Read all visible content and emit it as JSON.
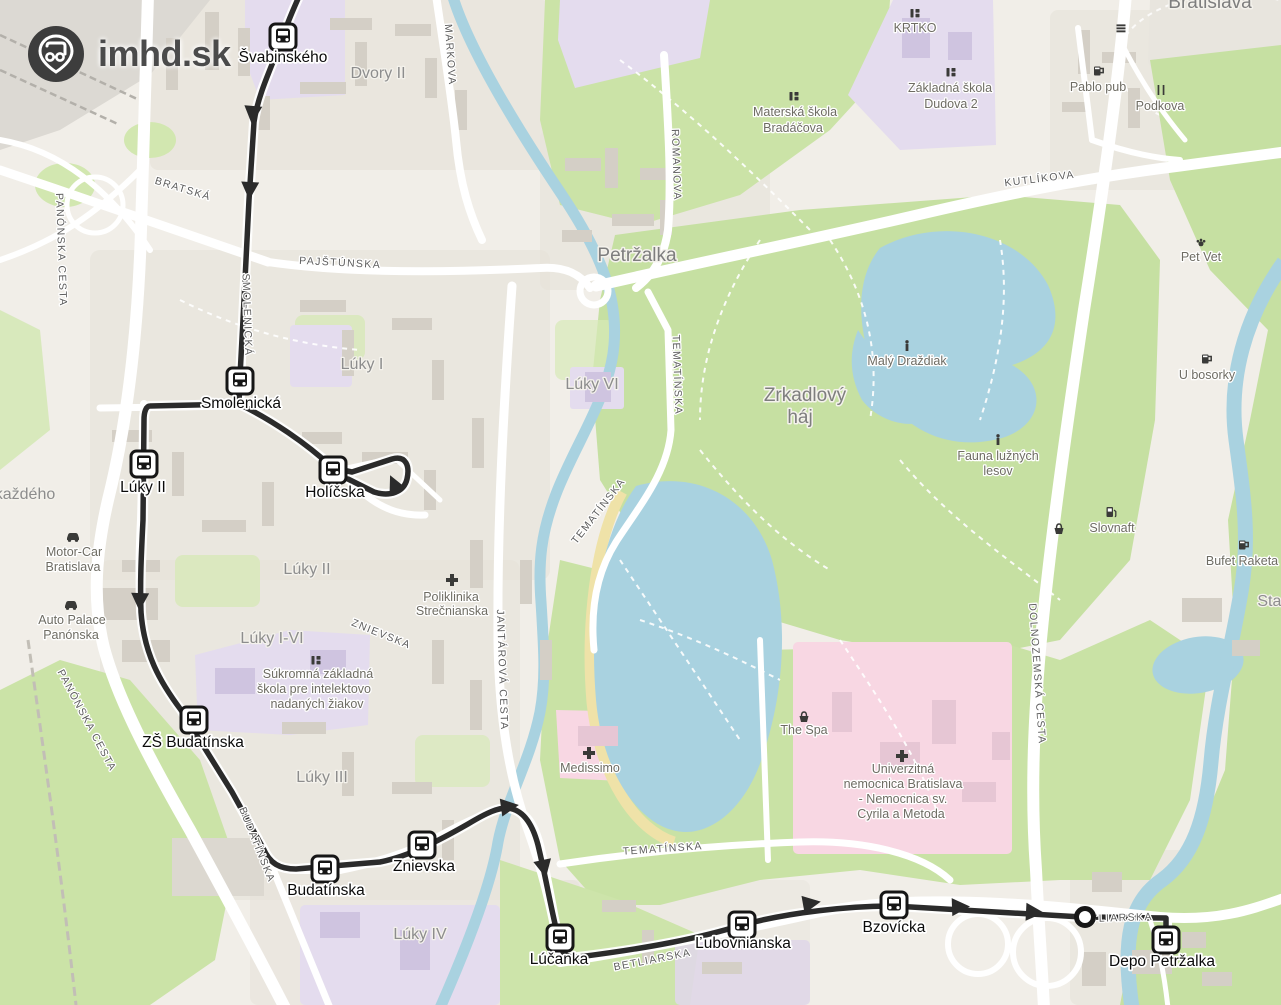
{
  "brand": {
    "site": "imhd.sk"
  },
  "map": {
    "route_color": "#2b2b2b",
    "water_color": "#a9d2e0",
    "park_color": "#cbe3a7",
    "hospital_area_color": "#f8d7e3",
    "school_area_color": "#e4dcee",
    "stops": [
      {
        "name": "Švabinského",
        "x": 283,
        "y": 37,
        "lx": 283,
        "ly": 62
      },
      {
        "name": "Smolenická",
        "x": 240,
        "y": 381,
        "lx": 241,
        "ly": 408
      },
      {
        "name": "Lúky II",
        "x": 144,
        "y": 464,
        "lx": 143,
        "ly": 492
      },
      {
        "name": "Holíčska",
        "x": 333,
        "y": 470,
        "lx": 335,
        "ly": 497
      },
      {
        "name": "ZŠ Budatínska",
        "x": 194,
        "y": 720,
        "lx": 193,
        "ly": 747
      },
      {
        "name": "Budatínska",
        "x": 325,
        "y": 869,
        "lx": 326,
        "ly": 895
      },
      {
        "name": "Znievska",
        "x": 422,
        "y": 845,
        "lx": 424,
        "ly": 871
      },
      {
        "name": "Lúčanka",
        "x": 560,
        "y": 938,
        "lx": 559,
        "ly": 964
      },
      {
        "name": "Ľubovnianska",
        "x": 742,
        "y": 925,
        "lx": 743,
        "ly": 948
      },
      {
        "name": "Bzovícka",
        "x": 894,
        "y": 905,
        "lx": 894,
        "ly": 932
      },
      {
        "name": "Depo Petržalka",
        "x": 1166,
        "y": 940,
        "lx": 1162,
        "ly": 966
      }
    ],
    "terminus": {
      "x": 1085,
      "y": 917
    },
    "street_labels": [
      {
        "text": "MARKOVA",
        "x": 447,
        "y": 55,
        "rot": 86
      },
      {
        "text": "BRATSKÁ",
        "x": 182,
        "y": 192,
        "rot": 17
      },
      {
        "text": "PAJŠTÚNSKA",
        "x": 340,
        "y": 266,
        "rot": 3
      },
      {
        "text": "ROMANOVA",
        "x": 673,
        "y": 165,
        "rot": 88
      },
      {
        "text": "KUTLÍKOVA",
        "x": 1040,
        "y": 182,
        "rot": -7
      },
      {
        "text": "PANÓNSKA CESTA",
        "x": 58,
        "y": 250,
        "rot": 88
      },
      {
        "text": "SMOLENICKÁ",
        "x": 244,
        "y": 315,
        "rot": 88
      },
      {
        "text": "TEMATÍNSKA",
        "x": 674,
        "y": 375,
        "rot": 88
      },
      {
        "text": "TEMATÍNSKA",
        "x": 601,
        "y": 513,
        "rot": -52
      },
      {
        "text": "JANTÁROVÁ CESTA",
        "x": 499,
        "y": 670,
        "rot": 88
      },
      {
        "text": "ZNIEVSKA",
        "x": 380,
        "y": 637,
        "rot": 22
      },
      {
        "text": "PANÓNSKA CESTA",
        "x": 84,
        "y": 722,
        "rot": 62
      },
      {
        "text": "BUDATÍNSKA",
        "x": 254,
        "y": 846,
        "rot": 68
      },
      {
        "text": "TEMATÍNSKA",
        "x": 663,
        "y": 852,
        "rot": -4
      },
      {
        "text": "BETLIARSKA",
        "x": 653,
        "y": 963,
        "rot": -11
      },
      {
        "text": "DOLNOZEMSKÁ CESTA",
        "x": 1034,
        "y": 674,
        "rot": 86
      },
      {
        "text": "TLIARSKA",
        "x": 1122,
        "y": 921,
        "rot": -2
      }
    ],
    "area_labels": [
      {
        "text": "Dvory II",
        "x": 378,
        "y": 78,
        "big": false
      },
      {
        "text": "Petržalka",
        "x": 637,
        "y": 261,
        "big": true
      },
      {
        "text": "Lúky I",
        "x": 362,
        "y": 369,
        "big": false
      },
      {
        "text": "Lúky VI",
        "x": 592,
        "y": 389,
        "big": false
      },
      {
        "text": "Zrkadlový",
        "x": 805,
        "y": 401,
        "big": true
      },
      {
        "text": "háj",
        "x": 800,
        "y": 423,
        "big": true
      },
      {
        "text": "Lúky II",
        "x": 307,
        "y": 574,
        "big": false
      },
      {
        "text": "Lúky I-VI",
        "x": 272,
        "y": 643,
        "big": false
      },
      {
        "text": "Lúky III",
        "x": 322,
        "y": 782,
        "big": false
      },
      {
        "text": "Lúky IV",
        "x": 420,
        "y": 939,
        "big": false
      },
      {
        "text": "Bratislava",
        "x": 1210,
        "y": 8,
        "big": true
      },
      {
        "text": "každého",
        "x": 25,
        "y": 499,
        "big": false,
        "small": true
      },
      {
        "text": "Star",
        "x": 1272,
        "y": 606,
        "big": false,
        "small": true
      }
    ],
    "pois": [
      {
        "icon": "school",
        "ix": 915,
        "iy": 13,
        "lines": [
          {
            "t": "KRTKO",
            "x": 915,
            "y": 32
          }
        ]
      },
      {
        "icon": "school",
        "ix": 951,
        "iy": 72,
        "lines": [
          {
            "t": "Základná škola",
            "x": 950,
            "y": 92
          },
          {
            "t": "Dudova 2",
            "x": 951,
            "y": 108
          }
        ]
      },
      {
        "icon": "school",
        "ix": 794,
        "iy": 96,
        "lines": [
          {
            "t": "Materská škola",
            "x": 795,
            "y": 116
          },
          {
            "t": "Bradáčova",
            "x": 793,
            "y": 132
          }
        ]
      },
      {
        "icon": "pub",
        "ix": 1098,
        "iy": 71,
        "lines": [
          {
            "t": "Pablo pub",
            "x": 1098,
            "y": 91
          }
        ]
      },
      {
        "icon": "restaurant",
        "ix": 1161,
        "iy": 90,
        "lines": [
          {
            "t": "Podkova",
            "x": 1160,
            "y": 110
          }
        ]
      },
      {
        "icon": "bench",
        "ix": 1121,
        "iy": 28,
        "lines": []
      },
      {
        "icon": "paw",
        "ix": 1201,
        "iy": 242,
        "lines": [
          {
            "t": "Pet Vet",
            "x": 1201,
            "y": 261
          }
        ]
      },
      {
        "icon": "pub",
        "ix": 1206,
        "iy": 359,
        "lines": [
          {
            "t": "U bosorky",
            "x": 1207,
            "y": 379
          }
        ]
      },
      {
        "icon": "info",
        "ix": 907,
        "iy": 346,
        "lines": [
          {
            "t": "Malý Draždiak",
            "x": 907,
            "y": 365
          }
        ]
      },
      {
        "icon": "info",
        "ix": 998,
        "iy": 440,
        "lines": [
          {
            "t": "Fauna lužných",
            "x": 998,
            "y": 460
          },
          {
            "t": "lesov",
            "x": 998,
            "y": 475
          }
        ]
      },
      {
        "icon": "fuel",
        "ix": 1111,
        "iy": 512,
        "lines": [
          {
            "t": "Slovnaft",
            "x": 1112,
            "y": 532
          }
        ]
      },
      {
        "icon": "basket",
        "ix": 1059,
        "iy": 529,
        "lines": []
      },
      {
        "icon": "pub",
        "ix": 1243,
        "iy": 545,
        "lines": [
          {
            "t": "Bufet Raketa",
            "x": 1242,
            "y": 565
          }
        ]
      },
      {
        "icon": "car",
        "ix": 73,
        "iy": 536,
        "lines": [
          {
            "t": "Motor-Car",
            "x": 74,
            "y": 556
          },
          {
            "t": "Bratislava",
            "x": 73,
            "y": 571
          }
        ]
      },
      {
        "icon": "car",
        "ix": 71,
        "iy": 604,
        "lines": [
          {
            "t": "Auto Palace",
            "x": 72,
            "y": 624
          },
          {
            "t": "Panónska",
            "x": 71,
            "y": 639
          }
        ]
      },
      {
        "icon": "cross",
        "ix": 452,
        "iy": 580,
        "lines": [
          {
            "t": "Poliklinika",
            "x": 451,
            "y": 601
          },
          {
            "t": "Strečnianska",
            "x": 452,
            "y": 615
          }
        ]
      },
      {
        "icon": "school",
        "ix": 316,
        "iy": 660,
        "lines": [
          {
            "t": "Súkromná základná",
            "x": 318,
            "y": 678
          },
          {
            "t": "škola pre intelektovo",
            "x": 314,
            "y": 693
          },
          {
            "t": "nadaných žiakov",
            "x": 317,
            "y": 708
          }
        ]
      },
      {
        "icon": "cross",
        "ix": 589,
        "iy": 753,
        "lines": [
          {
            "t": "Medissimo",
            "x": 590,
            "y": 772
          }
        ]
      },
      {
        "icon": "basket",
        "ix": 804,
        "iy": 717,
        "lines": [
          {
            "t": "The Spa",
            "x": 804,
            "y": 734
          }
        ]
      },
      {
        "icon": "cross",
        "ix": 902,
        "iy": 756,
        "lines": [
          {
            "t": "Univerzitná",
            "x": 903,
            "y": 773
          },
          {
            "t": "nemocnica Bratislava",
            "x": 903,
            "y": 788
          },
          {
            "t": "- Nemocnica sv.",
            "x": 903,
            "y": 803
          },
          {
            "t": "Cyrila a Metoda",
            "x": 901,
            "y": 818
          }
        ]
      }
    ]
  }
}
